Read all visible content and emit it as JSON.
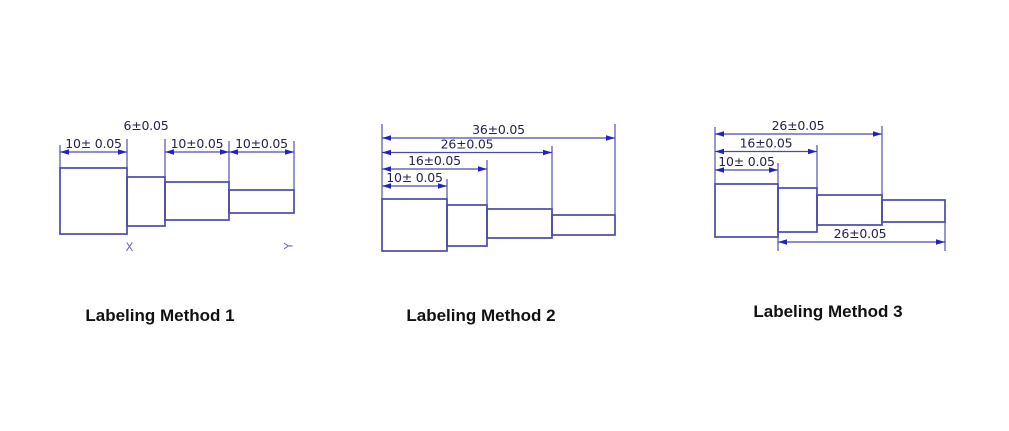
{
  "drawings": [
    {
      "caption": "Labeling Method 1",
      "dims": [
        "10± 0.05",
        "6±0.05",
        "10±0.05",
        "10±0.05"
      ],
      "marks": [
        "X",
        "Y"
      ]
    },
    {
      "caption": "Labeling Method 2",
      "dims": [
        "36±0.05",
        "26±0.05",
        "16±0.05",
        "10± 0.05"
      ]
    },
    {
      "caption": "Labeling Method 3",
      "dims": [
        "26±0.05",
        "16±0.05",
        "10± 0.05",
        "26±0.05"
      ]
    }
  ],
  "colors": {
    "line": "#4a4aab",
    "arrow": "#2222c4",
    "dim_text": "#23234f",
    "mark": "#6a6ab0",
    "caption_text": "#111111"
  }
}
